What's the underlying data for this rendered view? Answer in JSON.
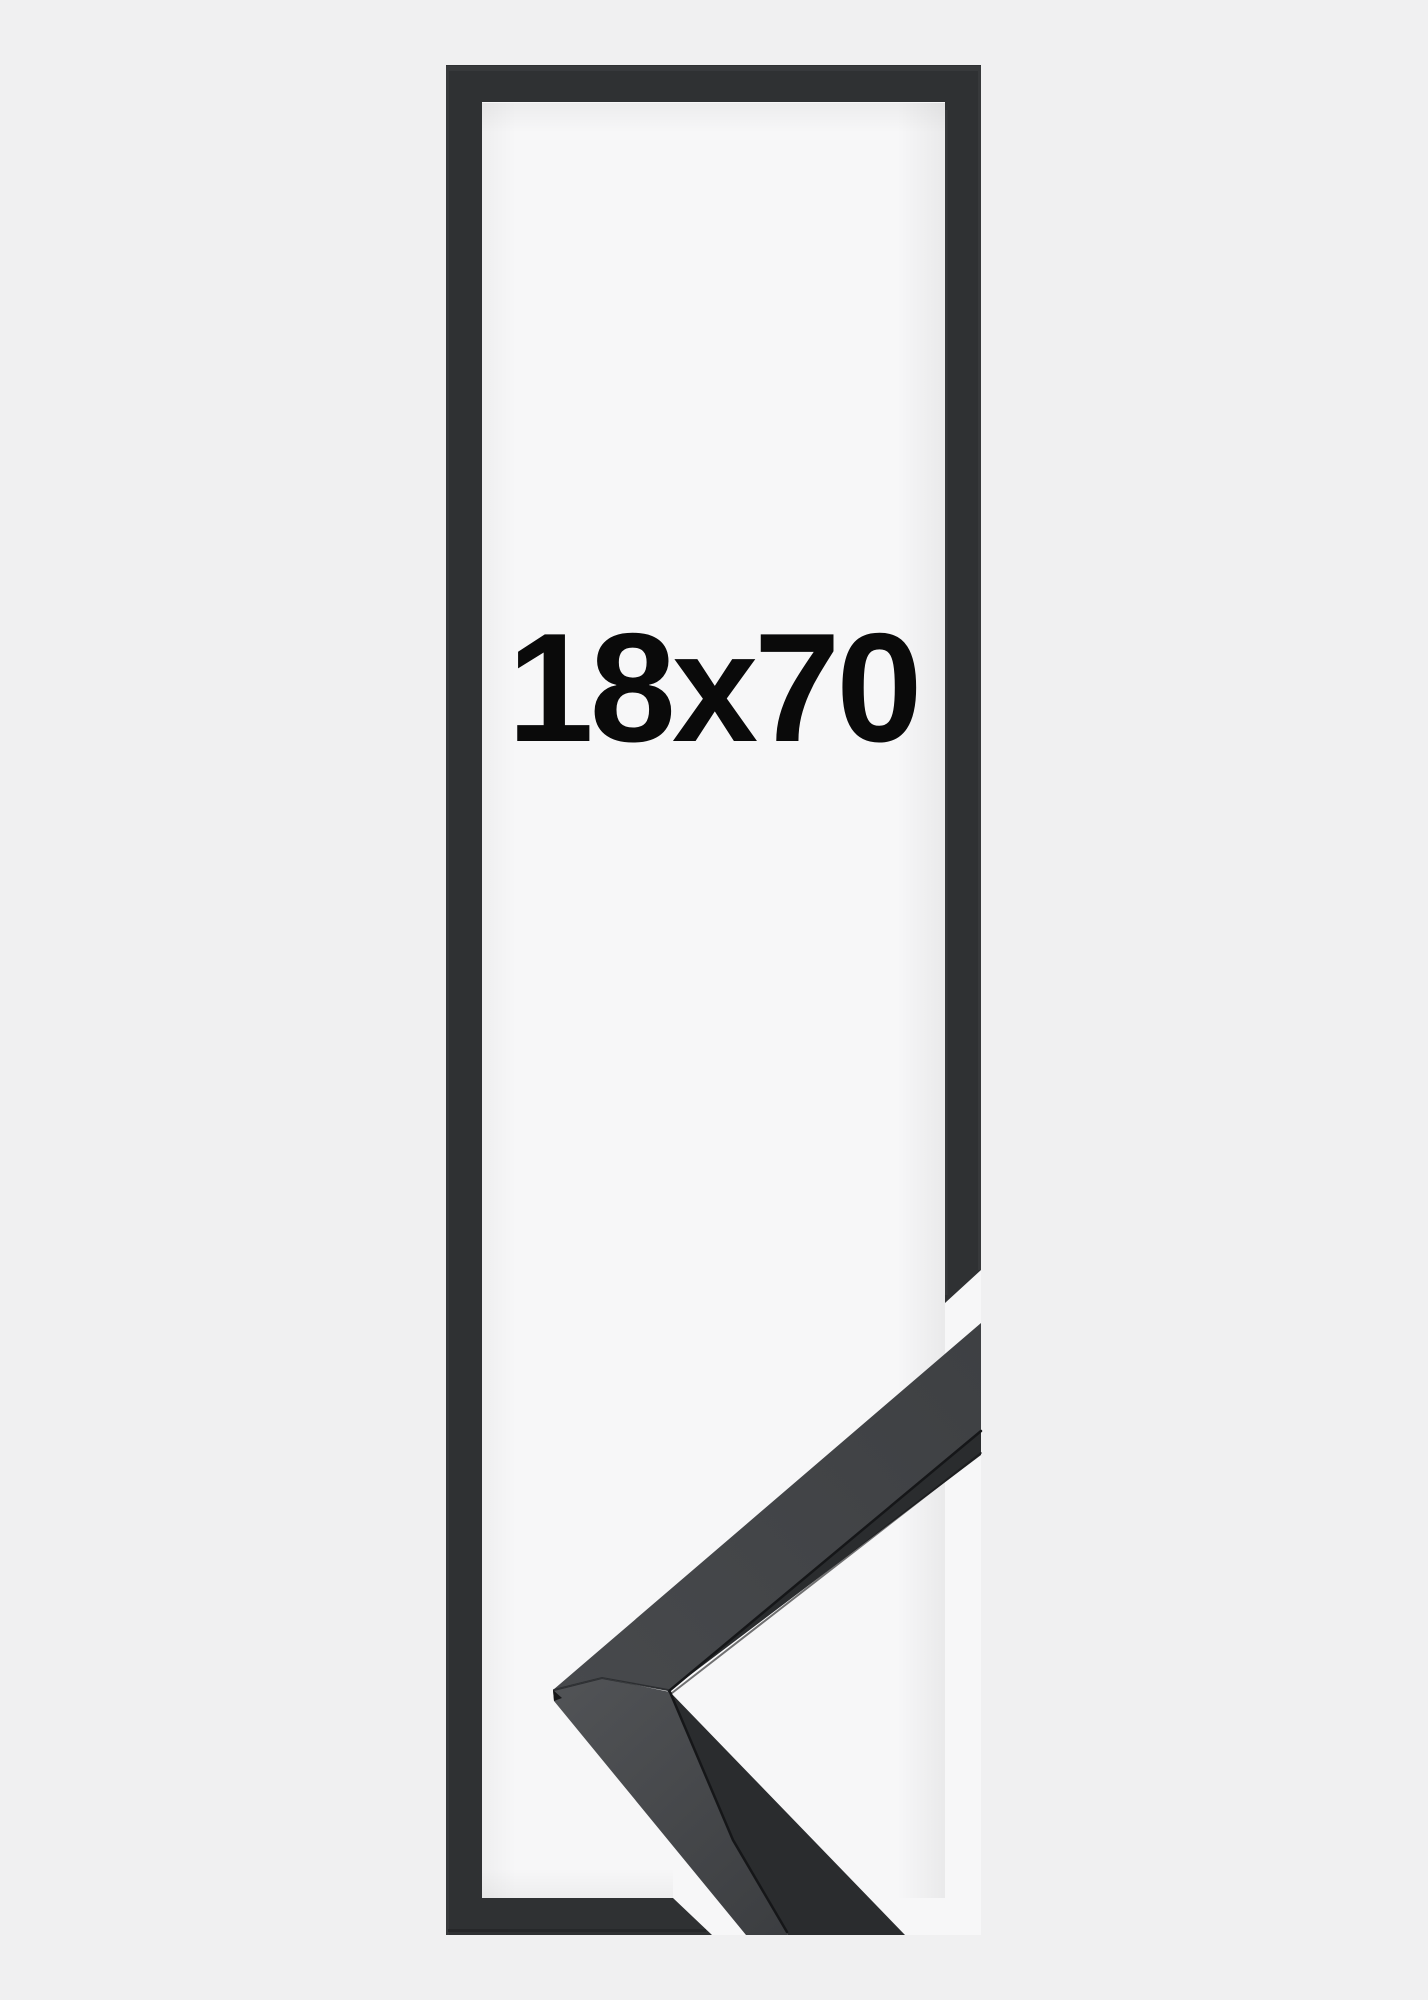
{
  "image": {
    "description_label": "empty picture frame size mockup with corner close-up",
    "size_label": "18x70",
    "colors": {
      "page_bg": "#f0f0f1",
      "photo_bg": "#f7f7f8",
      "frame": "#2f3133",
      "frame_edge_highlight": "#3e4043",
      "frame_bottom_shade": "#1f2022",
      "moulding_top_face": "#3e4043",
      "moulding_top_face_near": "#47494c",
      "moulding_side_face": "#505255",
      "moulding_side_face_far": "#3c3e41",
      "moulding_front": "#2a2c2e",
      "groove": "#151618",
      "mitre_seam": "#26282a",
      "text": "#0a0a0a"
    }
  }
}
